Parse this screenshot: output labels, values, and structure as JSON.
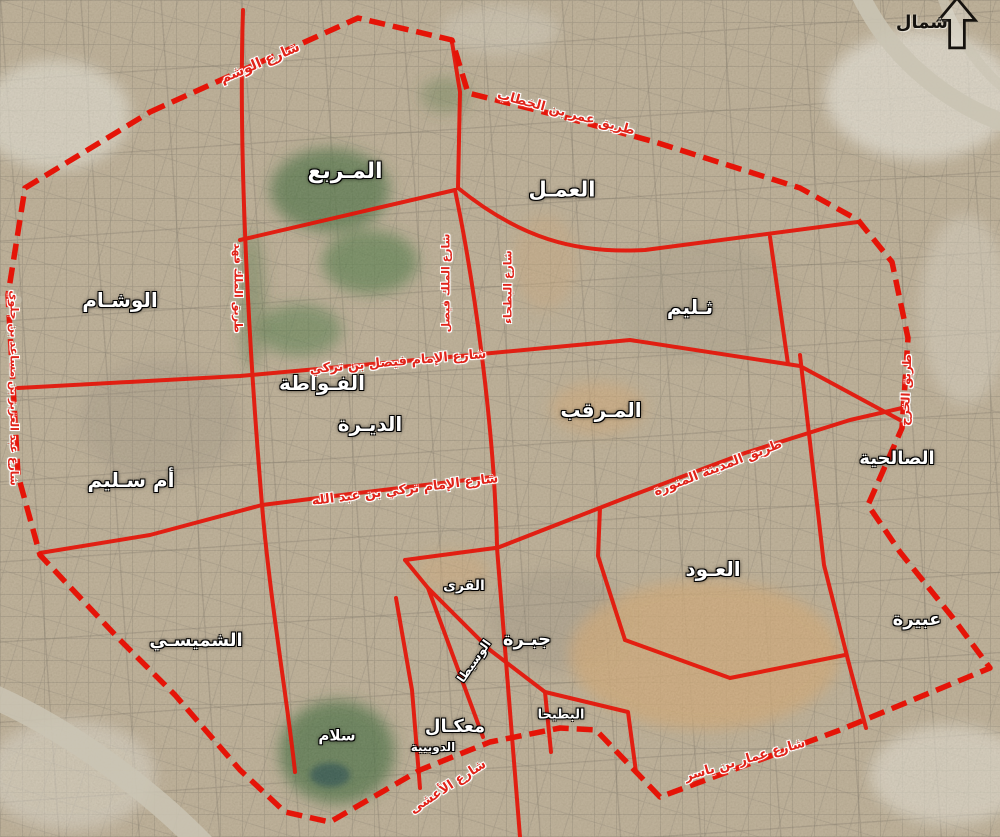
{
  "map": {
    "compass": {
      "label": "شمال"
    },
    "colors": {
      "boundary_red": "#e51408",
      "district_text": "#ffffff",
      "road_text": "#e0241a",
      "park_green": "#3f6637",
      "desert_tan": "#c9a06c"
    },
    "districts": [
      {
        "id": "murabba",
        "label": "المـربع",
        "x": 345,
        "y": 172,
        "size": 22,
        "rot": 0
      },
      {
        "id": "amal",
        "label": "العمـل",
        "x": 562,
        "y": 190,
        "size": 21,
        "rot": 0
      },
      {
        "id": "futah",
        "label": "الفـواطة",
        "x": 322,
        "y": 383,
        "size": 20,
        "rot": 0
      },
      {
        "id": "wisham",
        "label": "الوشـام",
        "x": 120,
        "y": 300,
        "size": 20,
        "rot": 0
      },
      {
        "id": "thulaim",
        "label": "ثـليم",
        "x": 690,
        "y": 307,
        "size": 20,
        "rot": 0
      },
      {
        "id": "dirah",
        "label": "الديـرة",
        "x": 370,
        "y": 424,
        "size": 20,
        "rot": 0
      },
      {
        "id": "margab",
        "label": "المـرقب",
        "x": 601,
        "y": 410,
        "size": 20,
        "rot": 0
      },
      {
        "id": "salhiyah",
        "label": "الصالحية",
        "x": 897,
        "y": 459,
        "size": 18,
        "rot": 0
      },
      {
        "id": "umm-saleem",
        "label": "أم سـليم",
        "x": 131,
        "y": 480,
        "size": 20,
        "rot": 0
      },
      {
        "id": "oud",
        "label": "العـود",
        "x": 713,
        "y": 569,
        "size": 20,
        "rot": 0
      },
      {
        "id": "ubayrah",
        "label": "عبيرة",
        "x": 917,
        "y": 620,
        "size": 18,
        "rot": 0
      },
      {
        "id": "shumaisi",
        "label": "الشميسـي",
        "x": 196,
        "y": 641,
        "size": 18,
        "rot": 0
      },
      {
        "id": "qura",
        "label": "القرى",
        "x": 464,
        "y": 586,
        "size": 14,
        "rot": 0
      },
      {
        "id": "jabrah",
        "label": "جبـرة",
        "x": 527,
        "y": 640,
        "size": 18,
        "rot": 0
      },
      {
        "id": "wusaita",
        "label": "الوسيطا",
        "x": 474,
        "y": 661,
        "size": 12,
        "rot": -55
      },
      {
        "id": "maakal",
        "label": "معكـال",
        "x": 455,
        "y": 727,
        "size": 18,
        "rot": 0
      },
      {
        "id": "dubiyah",
        "label": "الدوبيية",
        "x": 433,
        "y": 747,
        "size": 12,
        "rot": 0
      },
      {
        "id": "salam",
        "label": "سلام",
        "x": 337,
        "y": 736,
        "size": 15,
        "rot": 0
      },
      {
        "id": "batiha",
        "label": "البطيحا",
        "x": 561,
        "y": 715,
        "size": 13,
        "rot": 0
      }
    ],
    "roads": [
      {
        "id": "washm-st",
        "label": "شارع الوشم",
        "x": 260,
        "y": 63,
        "rot": -23,
        "size": 14
      },
      {
        "id": "omar-bin-alkhattab",
        "label": "طريق عمر بن الخطاب",
        "x": 566,
        "y": 113,
        "rot": 15,
        "size": 13
      },
      {
        "id": "king-fahd-rd",
        "label": "طريق الملك فهد",
        "x": 238,
        "y": 288,
        "rot": 90,
        "size": 11
      },
      {
        "id": "king-faisal-st",
        "label": "شارع الملك فيصل",
        "x": 446,
        "y": 283,
        "rot": -90,
        "size": 11
      },
      {
        "id": "batha-st",
        "label": "شارع البطحاء",
        "x": 508,
        "y": 287,
        "rot": -90,
        "size": 11
      },
      {
        "id": "imam-faisal-bin-turki",
        "label": "شارع الإمام فيصل بن تركي",
        "x": 398,
        "y": 362,
        "rot": -5,
        "size": 13
      },
      {
        "id": "imam-turki",
        "label": "شارع الإمام تركي بن عبد الله",
        "x": 405,
        "y": 490,
        "rot": -7,
        "size": 13
      },
      {
        "id": "madinah-rd",
        "label": "طريق المدينة المنورة",
        "x": 718,
        "y": 468,
        "rot": -21,
        "size": 13
      },
      {
        "id": "kharj-rd",
        "label": "طريق الخرج",
        "x": 906,
        "y": 390,
        "rot": -88,
        "size": 12
      },
      {
        "id": "abdulaziz-bin-musaid",
        "label": "شارع عبد العزيز بن مساعد بن جلوي",
        "x": 14,
        "y": 388,
        "rot": 90,
        "size": 11
      },
      {
        "id": "ammar-bin-yasser",
        "label": "شارع عمار بن ياسر",
        "x": 745,
        "y": 760,
        "rot": -16,
        "size": 13
      },
      {
        "id": "aasha-st",
        "label": "شارع الأعشى",
        "x": 448,
        "y": 787,
        "rot": -33,
        "size": 13
      }
    ]
  }
}
